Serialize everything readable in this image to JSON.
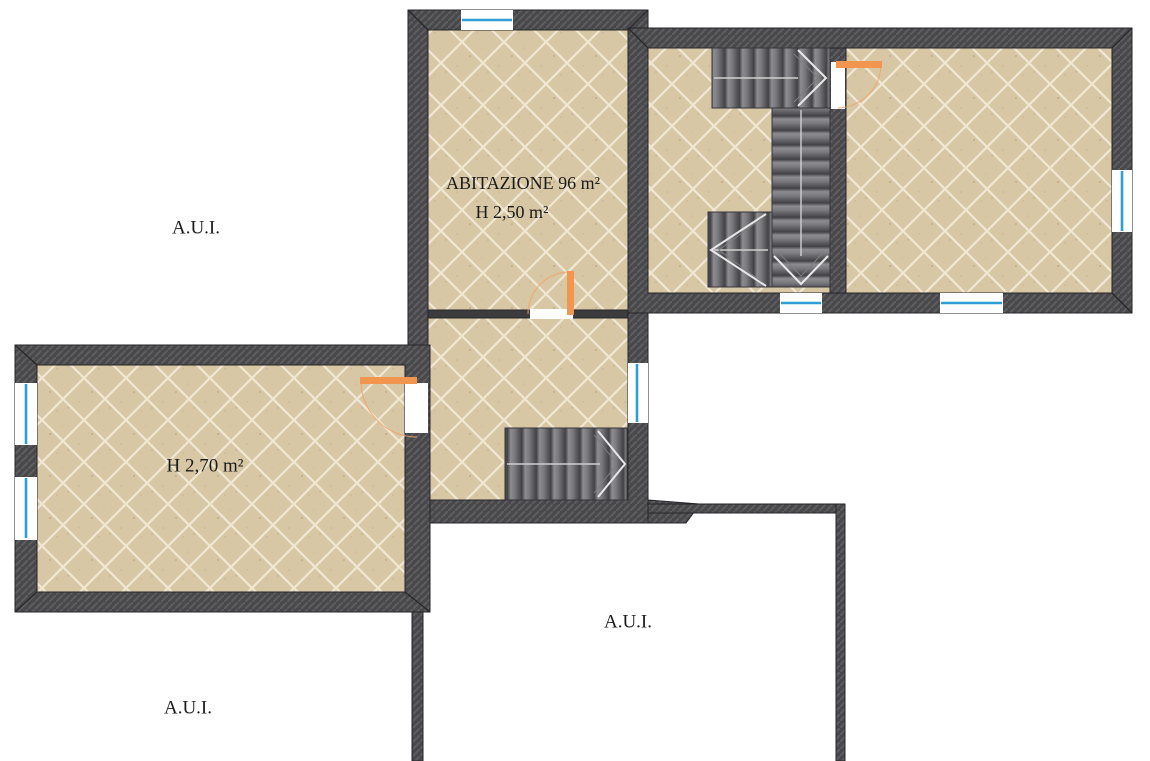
{
  "labels": {
    "abitazione_area": "ABITAZIONE 96 m²",
    "abitazione_height": "H 2,50 m²",
    "left_room_height": "H 2,70 m²",
    "aui_upper_left": "A.U.I.",
    "aui_center": "A.U.I.",
    "aui_lower_left": "A.U.I."
  },
  "colors": {
    "background": "#ffffff",
    "wall_fill": "#48484b",
    "wall_hatch": "#5e5e62",
    "wall_outline": "#26262a",
    "floor_tile": "#d8c7a4",
    "floor_grout": "#f0e8d4",
    "stair_gray": "#6f6f73",
    "stair_arrow": "#e8e8e8",
    "window_blue": "#2d9fd6",
    "door_orange": "#f2954f",
    "text": "#1b1b1b"
  },
  "symbols": [
    "window-icon",
    "door-swing-icon",
    "stair-run-icon",
    "direction-arrow-icon"
  ]
}
